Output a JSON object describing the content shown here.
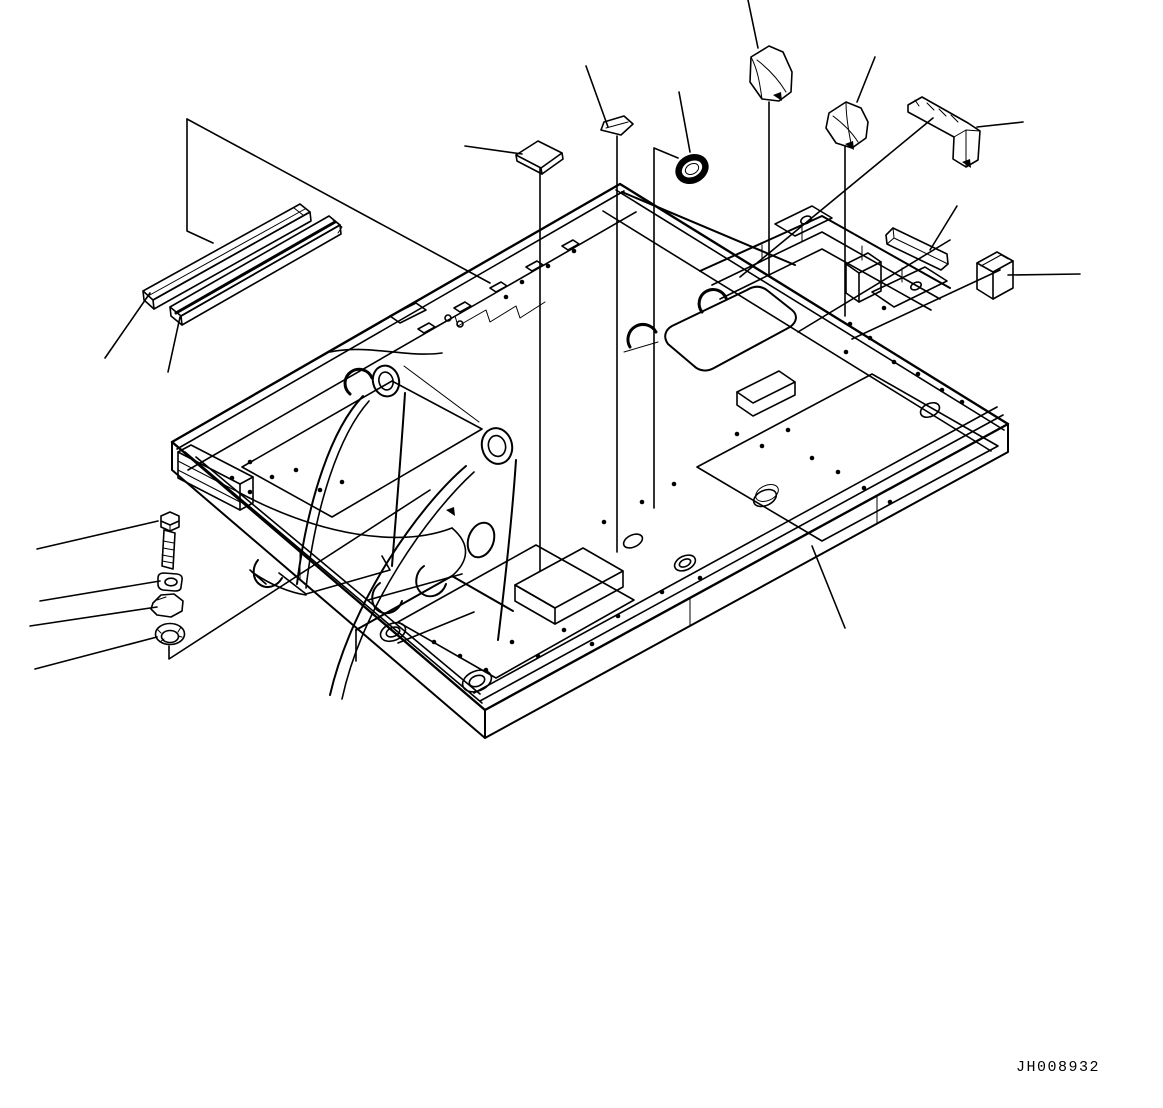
{
  "figure": {
    "drawing_number": "JH008932",
    "background_color": "#ffffff",
    "line_color": "#000000",
    "diagram_type": "exploded parts line drawing",
    "parts": [
      "main-frame",
      "seal-strip-upper",
      "seal-strip-lower",
      "square-pad",
      "small-pad",
      "ring-grommet",
      "cover-block-front",
      "cover-block-rear",
      "corner-cushion-block",
      "bar-strip",
      "pad-block",
      "hex-bolt",
      "washer",
      "plug",
      "cap"
    ]
  }
}
